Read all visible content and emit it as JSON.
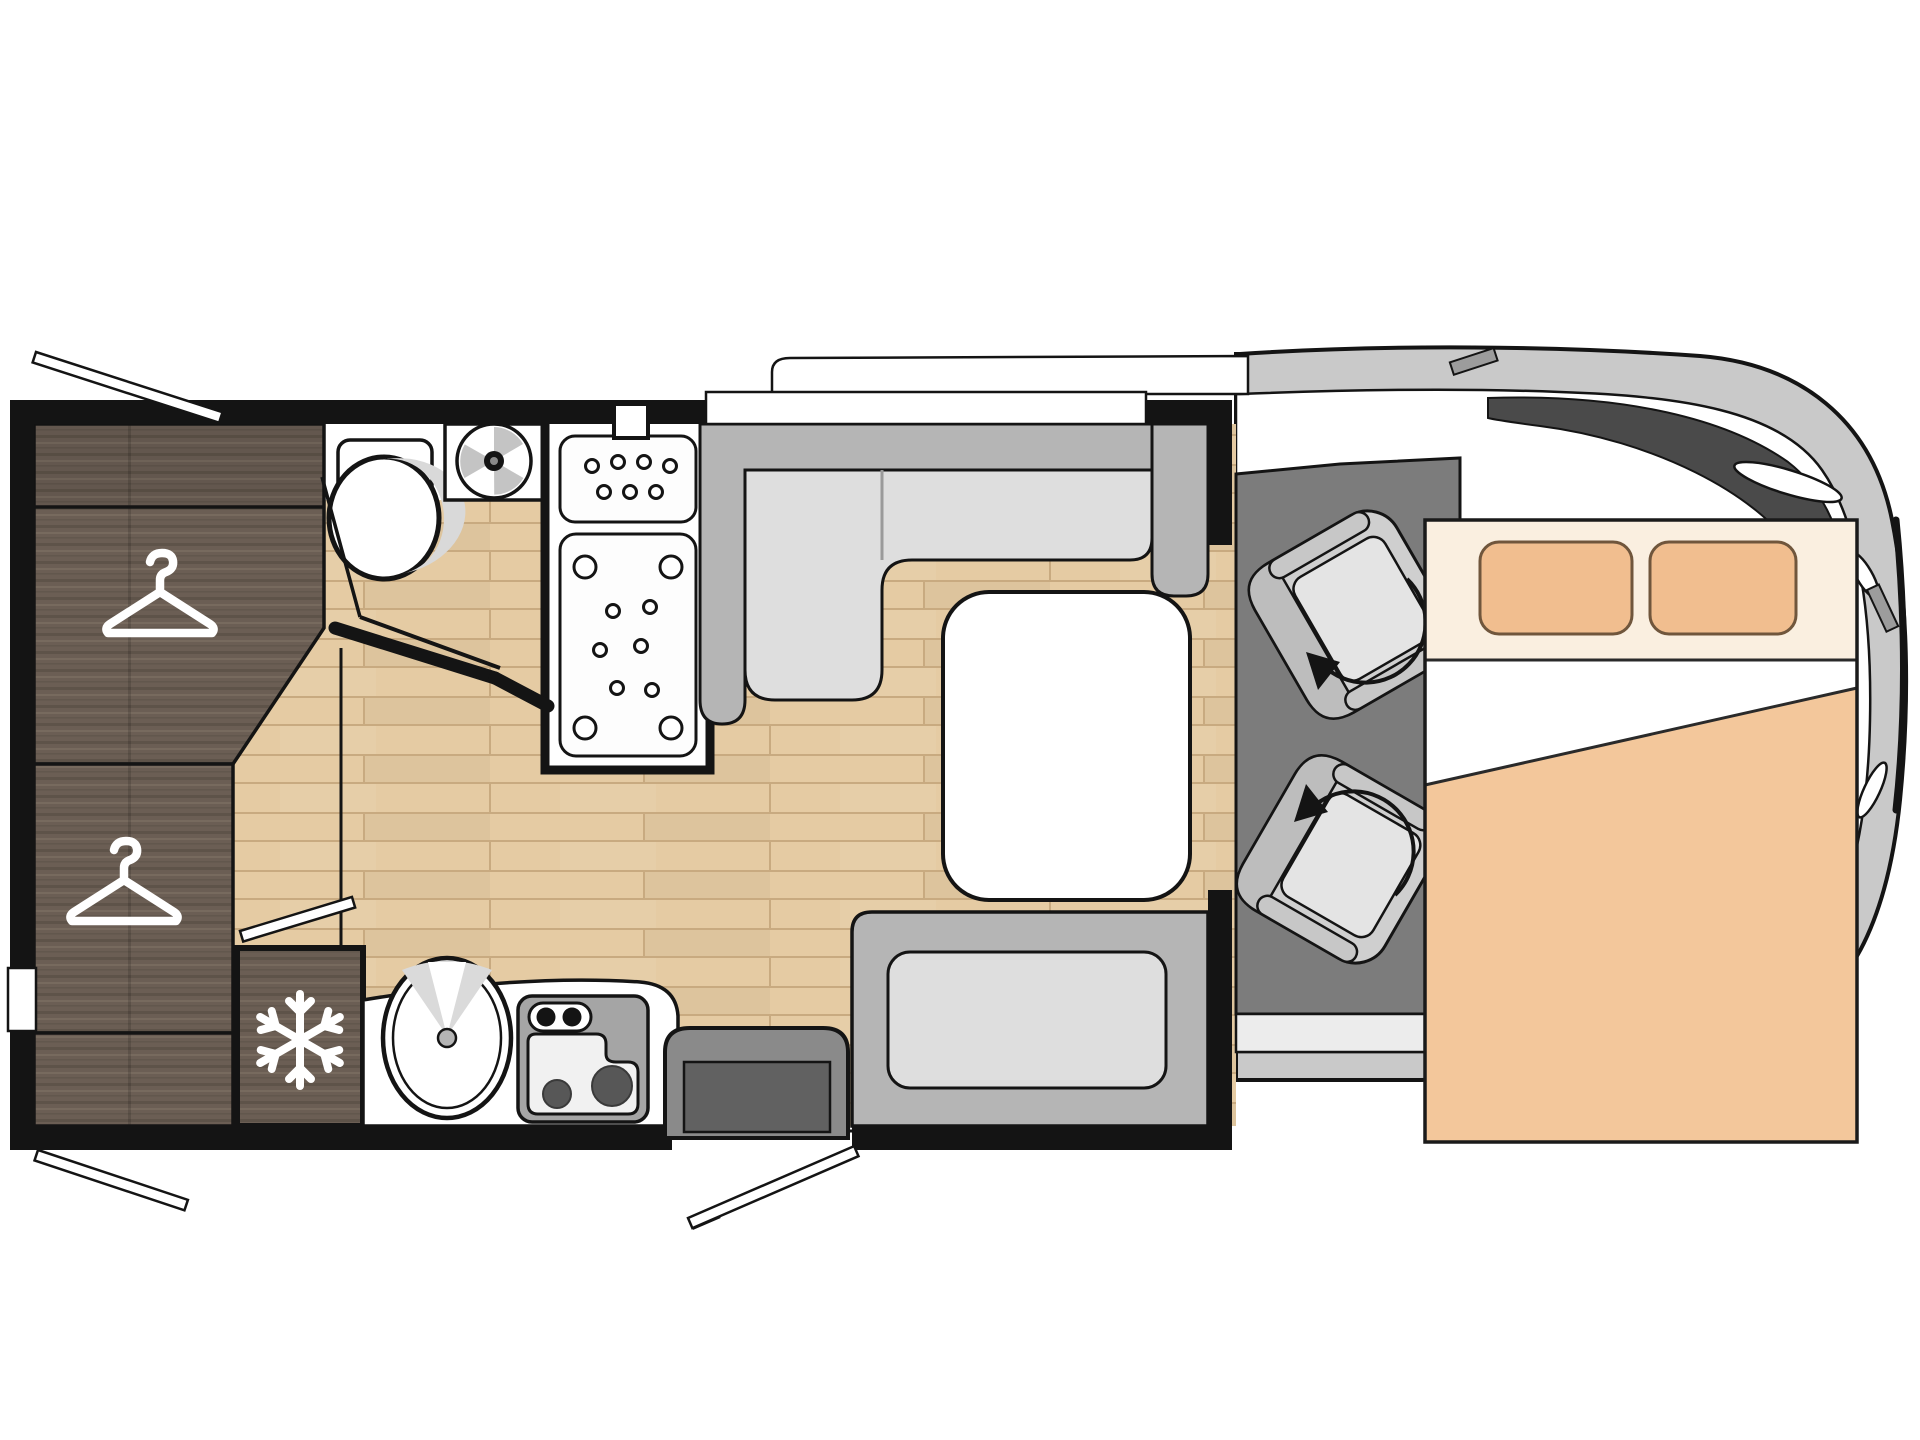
{
  "meta": {
    "title": "Motorhome floor plan - top view",
    "type": "floorplan-diagram",
    "text_labels": []
  },
  "colors": {
    "wall": "#141414",
    "wood": "#E5CBA3",
    "wood_line": "#C8AA80",
    "dark_wood": "#6B5E54",
    "dark_wood_streak": "#5C5147",
    "dark_wood_light": "#7C6F62",
    "bench_back": "#B5B5B5",
    "bench_seat": "#DEDEDE",
    "cab_floor": "#7C7C7C",
    "vehicle_band": "#C9C9C9",
    "windshield": "#4A4A4A",
    "seat_base": "#CFCFCF",
    "seat_pan": "#E4E4E4",
    "seat_trim": "#BDBDBD",
    "bed_head": "#FAEFE0",
    "pillow": "#F1BE8F",
    "pillow_outline": "#70563C",
    "mattress": "#F3C79B",
    "sheet": "#FFFFFF",
    "step_outer": "#8A8A8A",
    "step_inner": "#616161",
    "stove_frame": "#A5A5A5",
    "burner": "#575757",
    "skirt": "#ECECEC",
    "table": "#FFFFFF",
    "white_fixture": "#FFFFFF"
  },
  "inventory": {
    "wardrobe_hanger_icons": 2,
    "fridge_snowflake_icons": 1,
    "swivel_cab_seats": 2,
    "seat_rotation_arrows": 2,
    "bed_pillows": 2,
    "stove_burners": 2,
    "stove_knobs": 2,
    "shower_trays": 2,
    "door_swing_lines": 4,
    "toilet": 1,
    "vent_fan": 1,
    "sink": 1,
    "table": 1,
    "dinette_l_bench": 1,
    "rear_bench": 1,
    "entry_step": 1
  }
}
